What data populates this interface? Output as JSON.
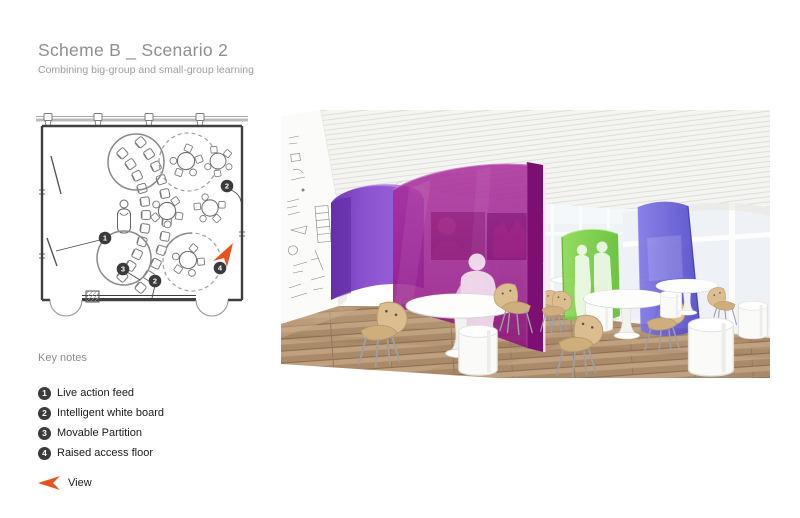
{
  "header": {
    "title": "Scheme B _ Scenario 2",
    "subtitle": "Combining big-group and small-group learning"
  },
  "key_notes": {
    "heading": "Key notes",
    "items": [
      {
        "num": "1",
        "label": "Live action feed"
      },
      {
        "num": "2",
        "label": "Intelligent white board"
      },
      {
        "num": "3",
        "label": "Movable Partition"
      },
      {
        "num": "4",
        "label": "Raised access floor"
      }
    ],
    "view_label": "View"
  },
  "floor_plan": {
    "markers": [
      "1",
      "2",
      "3",
      "2",
      "4"
    ]
  },
  "colors": {
    "accent_orange": "#E8521C",
    "marker_dark": "#3B3B3B",
    "partition_purple": "#8A4FD0",
    "partition_magenta": "#A01F92",
    "partition_green": "#6FCC3A",
    "partition_blue": "#5A52D6",
    "floor_wood": "#B49674",
    "title_gray": "#8F8F8F"
  }
}
